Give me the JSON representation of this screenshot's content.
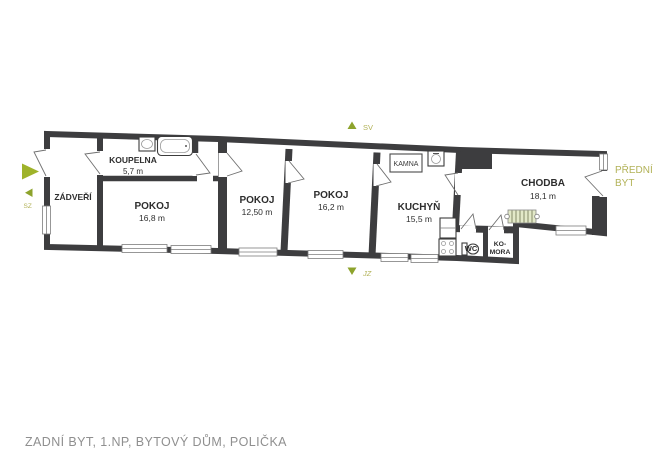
{
  "caption": "ZADNÍ BYT, 1.NP, BYTOVÝ DŮM, POLIČKA",
  "compass": {
    "ne": "SV",
    "sw": "JZ",
    "nw": "SZ"
  },
  "adjacent_unit": {
    "line1": "PŘEDNÍ",
    "line2": "BYT"
  },
  "rooms": {
    "zadveri": {
      "name": "ZÁDVEŘÍ"
    },
    "koupelna": {
      "name": "KOUPELNA",
      "area": "5,7 m"
    },
    "pokoj1": {
      "name": "POKOJ",
      "area": "16,8 m"
    },
    "pokoj2": {
      "name": "POKOJ",
      "area": "12,50 m"
    },
    "pokoj3": {
      "name": "POKOJ",
      "area": "16,2 m"
    },
    "kuchyn": {
      "name": "KUCHYŇ",
      "area": "15,5 m"
    },
    "chodba": {
      "name": "CHODBA",
      "area": "18,1 m"
    },
    "wc": {
      "name": "WC"
    },
    "komora": {
      "line1": "KO-",
      "line2": "MORA"
    }
  },
  "fixtures": {
    "kamna_label": "KAMNA"
  },
  "icons": [
    "entrance-arrow-icon",
    "compass-north-icon",
    "compass-south-icon",
    "compass-west-icon",
    "bathtub-icon",
    "bathroom-sink-icon",
    "kitchen-sink-icon",
    "stove-icon",
    "kitchen-counter-icon",
    "toilet-icon",
    "stairs-icon"
  ],
  "colors": {
    "wall": "#3d3d3f",
    "room_fill": "#d9eaf6",
    "accent_green": "#9fb32a",
    "olive_text": "#b2b258",
    "caption_gray": "#8f8f8f"
  }
}
